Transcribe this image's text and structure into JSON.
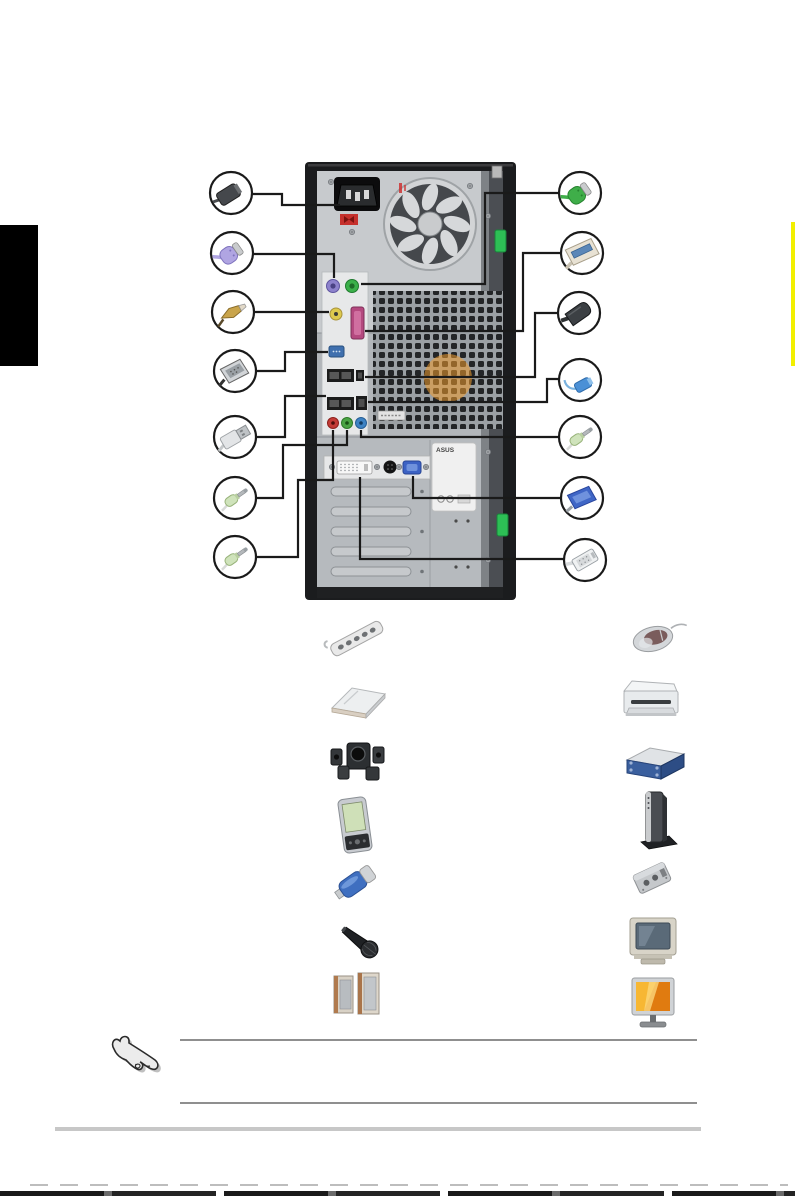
{
  "page": {
    "width": 795,
    "height": 1197,
    "background": "#ffffff"
  },
  "side_tabs": {
    "left_chapter_tab": {
      "color": "#000000"
    },
    "right_edge_tab": {
      "color": "#f2ef00"
    }
  },
  "figure": {
    "tower": {
      "brand_sticker_text": "ASUS",
      "ports": [
        "ac-power-inlet",
        "voltage-selector-switch",
        "psu-fan",
        "ps2-keyboard-port",
        "ps2-mouse-port",
        "yellow-spdif-jack",
        "parallel-port",
        "serial-port",
        "usb-ports-top-row",
        "firewire-port",
        "usb-ports-bottom-row",
        "lan-port",
        "mic-jack",
        "line-out-jack",
        "line-in-jack",
        "dvi-port",
        "s-video-port",
        "vga-port",
        "expansion-slot-covers",
        "green-latch-upper",
        "green-latch-lower"
      ]
    },
    "callouts_left": [
      {
        "name": "power-cord-plug",
        "color": "#45484c"
      },
      {
        "name": "ps2-keyboard-connector",
        "color": "#b0a5e2"
      },
      {
        "name": "gold-rca-plug",
        "color": "#c9a44b"
      },
      {
        "name": "serial-db9-connector",
        "color": "#d2d5d8"
      },
      {
        "name": "usb-connector",
        "color": "#e3e5e7"
      },
      {
        "name": "audio-plug-upper",
        "color": "#cfe3bb"
      },
      {
        "name": "audio-plug-lower",
        "color": "#cfe3bb"
      }
    ],
    "callouts_right": [
      {
        "name": "ps2-mouse-connector",
        "color": "#3fae49"
      },
      {
        "name": "parallel-db25-connector",
        "color": "#e8e2d4"
      },
      {
        "name": "firewire-connector",
        "color": "#3c4044"
      },
      {
        "name": "mini-usb-blue-cable",
        "color": "#4b90d6"
      },
      {
        "name": "audio-plug",
        "color": "#cfe3bb"
      },
      {
        "name": "vga-connector",
        "color": "#3f66c6"
      },
      {
        "name": "dvi-connector",
        "color": "#eff1f2"
      }
    ]
  },
  "devices": {
    "left_column": [
      {
        "name": "power-strip"
      },
      {
        "name": "modem"
      },
      {
        "name": "multichannel-speakers"
      },
      {
        "name": "pda"
      },
      {
        "name": "usb-flash-drive"
      },
      {
        "name": "microphone"
      },
      {
        "name": "stereo-speakers"
      }
    ],
    "right_column": [
      {
        "name": "mouse"
      },
      {
        "name": "printer"
      },
      {
        "name": "external-drive"
      },
      {
        "name": "external-modem"
      },
      {
        "name": "audio-adapter"
      },
      {
        "name": "crt-monitor"
      },
      {
        "name": "lcd-monitor"
      }
    ]
  },
  "note": {
    "icon": "pointing-hand-icon",
    "text": ""
  },
  "colors": {
    "case_black": "#1b1c1e",
    "panel_gray": "#b2b6ba",
    "psu_gray": "#c7cacd",
    "ps2_keyboard": "#8d82cc",
    "ps2_mouse": "#3bb04a",
    "yellow_jack": "#ddc94e",
    "parallel_port": "#b4497f",
    "serial_port": "#3f6fae",
    "mic_jack": "#c23b36",
    "lineout_jack": "#4aa344",
    "linein_jack": "#3e83c4",
    "vga_port": "#3c62c4",
    "latch_green": "#2dbf55",
    "fan_sticker_orange": "#f09c2e",
    "lcd_screen_orange": "#f59b1e"
  }
}
